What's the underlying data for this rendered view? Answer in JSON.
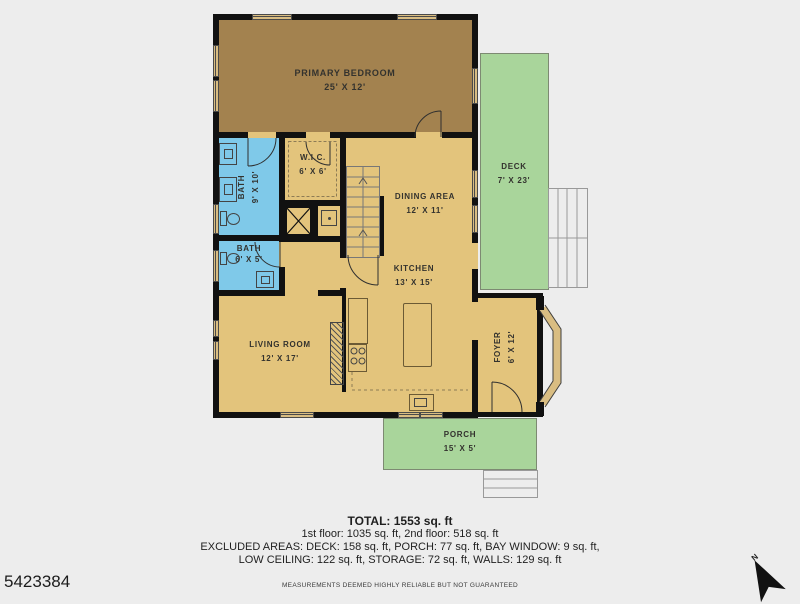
{
  "plan_id": "5423384",
  "compass": {
    "label": "N"
  },
  "rooms": {
    "primary_bedroom": {
      "name": "PRIMARY BEDROOM",
      "dims": "25' X 12'"
    },
    "bath1": {
      "name": "BATH",
      "dims": "9' X 10'"
    },
    "bath2": {
      "name": "BATH",
      "dims": "6' X 5'"
    },
    "wic": {
      "name": "W.I.C.",
      "dims": "6' X 6'"
    },
    "dining": {
      "name": "DINING AREA",
      "dims": "12' X 11'"
    },
    "kitchen": {
      "name": "KITCHEN",
      "dims": "13' X 15'"
    },
    "living": {
      "name": "LIVING ROOM",
      "dims": "12' X 17'"
    },
    "foyer": {
      "name": "FOYER",
      "dims": "6' X 12'"
    },
    "deck": {
      "name": "DECK",
      "dims": "7' X 23'"
    },
    "porch": {
      "name": "PORCH",
      "dims": "15' X 5'"
    }
  },
  "summary": {
    "total": "TOTAL: 1553 sq. ft",
    "line1": "1st floor: 1035 sq. ft, 2nd floor: 518 sq. ft",
    "line2": "EXCLUDED AREAS: DECK: 158 sq. ft, PORCH: 77 sq. ft, BAY WINDOW: 9 sq. ft,",
    "line3": "LOW CEILING: 122 sq. ft, STORAGE: 72 sq. ft, WALLS: 129 sq. ft"
  },
  "disclaimer": "MEASUREMENTS DEEMED HIGHLY RELIABLE BUT NOT GUARANTEED",
  "colors": {
    "background": "#ededed",
    "walls": "#111111",
    "room_tan": "#e3c47c",
    "bedroom_tan": "#a3824f",
    "bath_blue": "#7fc9e9",
    "outdoor_green": "#a9d59b",
    "window_fill": "#d9bd82"
  }
}
